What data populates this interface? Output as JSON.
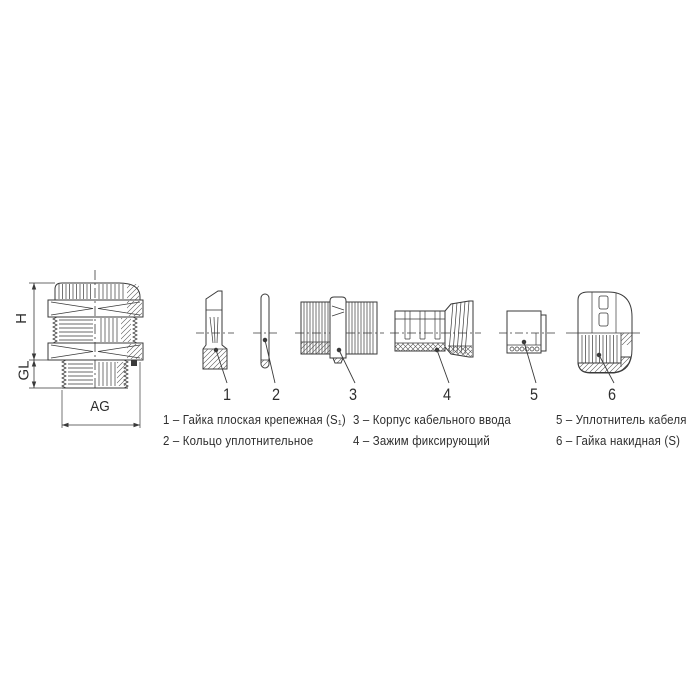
{
  "assembled_view": {
    "dim_height": "H",
    "dim_gland_length": "GL",
    "dim_thread": "AG"
  },
  "parts": [
    {
      "number": "1",
      "legend": "1 – Гайка плоская крепежная (S₁)"
    },
    {
      "number": "2",
      "legend": "2 – Кольцо уплотнительное"
    },
    {
      "number": "3",
      "legend": "3 – Корпус кабельного ввода"
    },
    {
      "number": "4",
      "legend": "4 – Зажим фиксирующий"
    },
    {
      "number": "5",
      "legend": "5 – Уплотнитель кабеля"
    },
    {
      "number": "6",
      "legend": "6 – Гайка накидная (S)"
    }
  ]
}
